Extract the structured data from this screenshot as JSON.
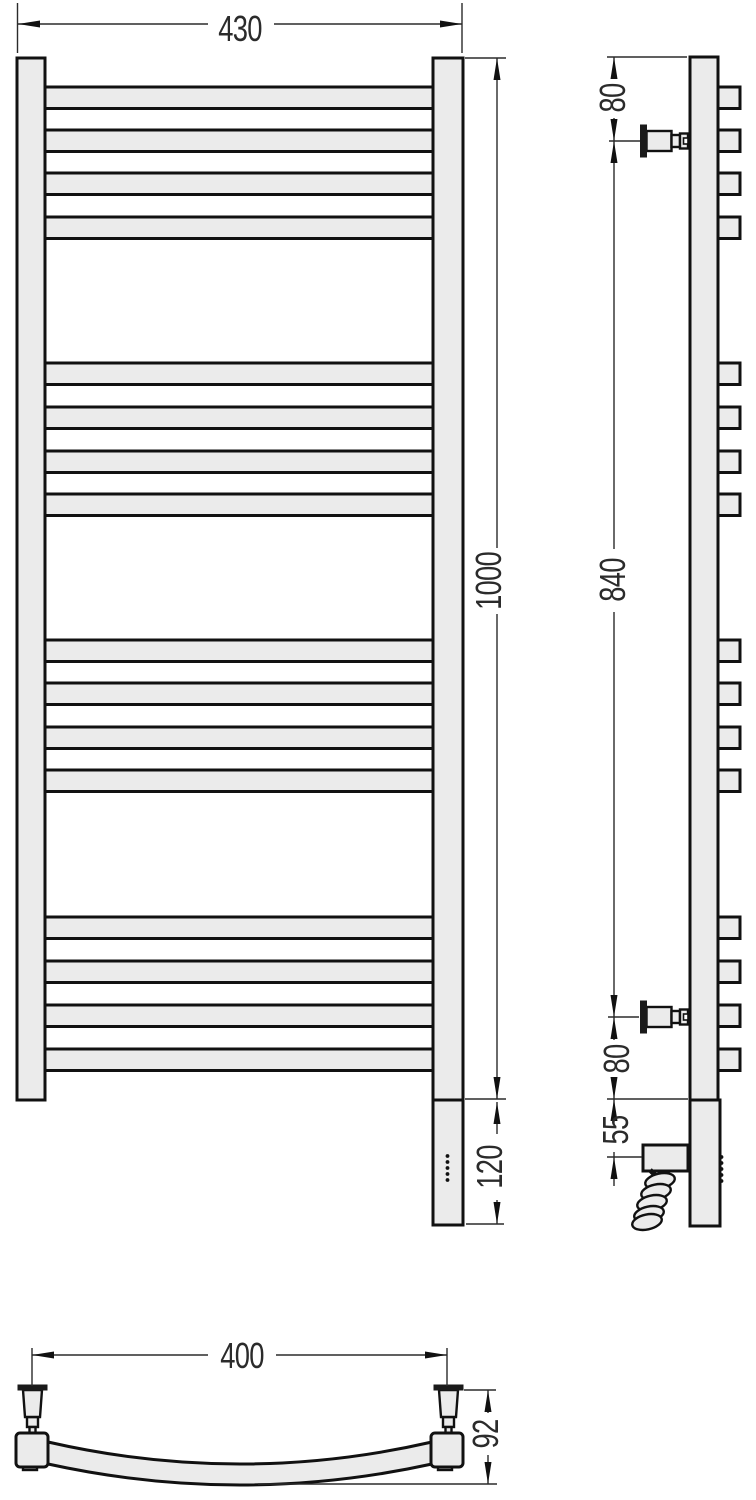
{
  "dimensions": {
    "front_width": "430",
    "front_height": "1000",
    "heater_section_height": "120",
    "side_top_offset": "80",
    "side_bracket_span": "840",
    "side_bottom_offset": "80",
    "side_element_offset": "55",
    "top_bracket_span": "400",
    "top_depth": "92"
  },
  "drawing": {
    "rung_tops": [
      87,
      130,
      173,
      217,
      363,
      407,
      451,
      494,
      640,
      683,
      727,
      770,
      917,
      961,
      1005,
      1049
    ],
    "rung_height": 21.5,
    "front_rung_x": 45,
    "front_rung_w": 388,
    "side_square_x": 718,
    "side_square_w": 22,
    "bracket_centers": [
      141,
      1017
    ],
    "front_dots": {
      "cx": 447.5,
      "start_y": 1156,
      "step": 6,
      "count": 5,
      "r": 1.9
    },
    "side_dots": {
      "cx": 721.5,
      "start_y": 1157,
      "step": 6,
      "count": 5,
      "r": 1.9
    },
    "colors": {
      "fill": "#ebebeb",
      "line": "#111111",
      "dim": "#2b2b2b"
    }
  }
}
